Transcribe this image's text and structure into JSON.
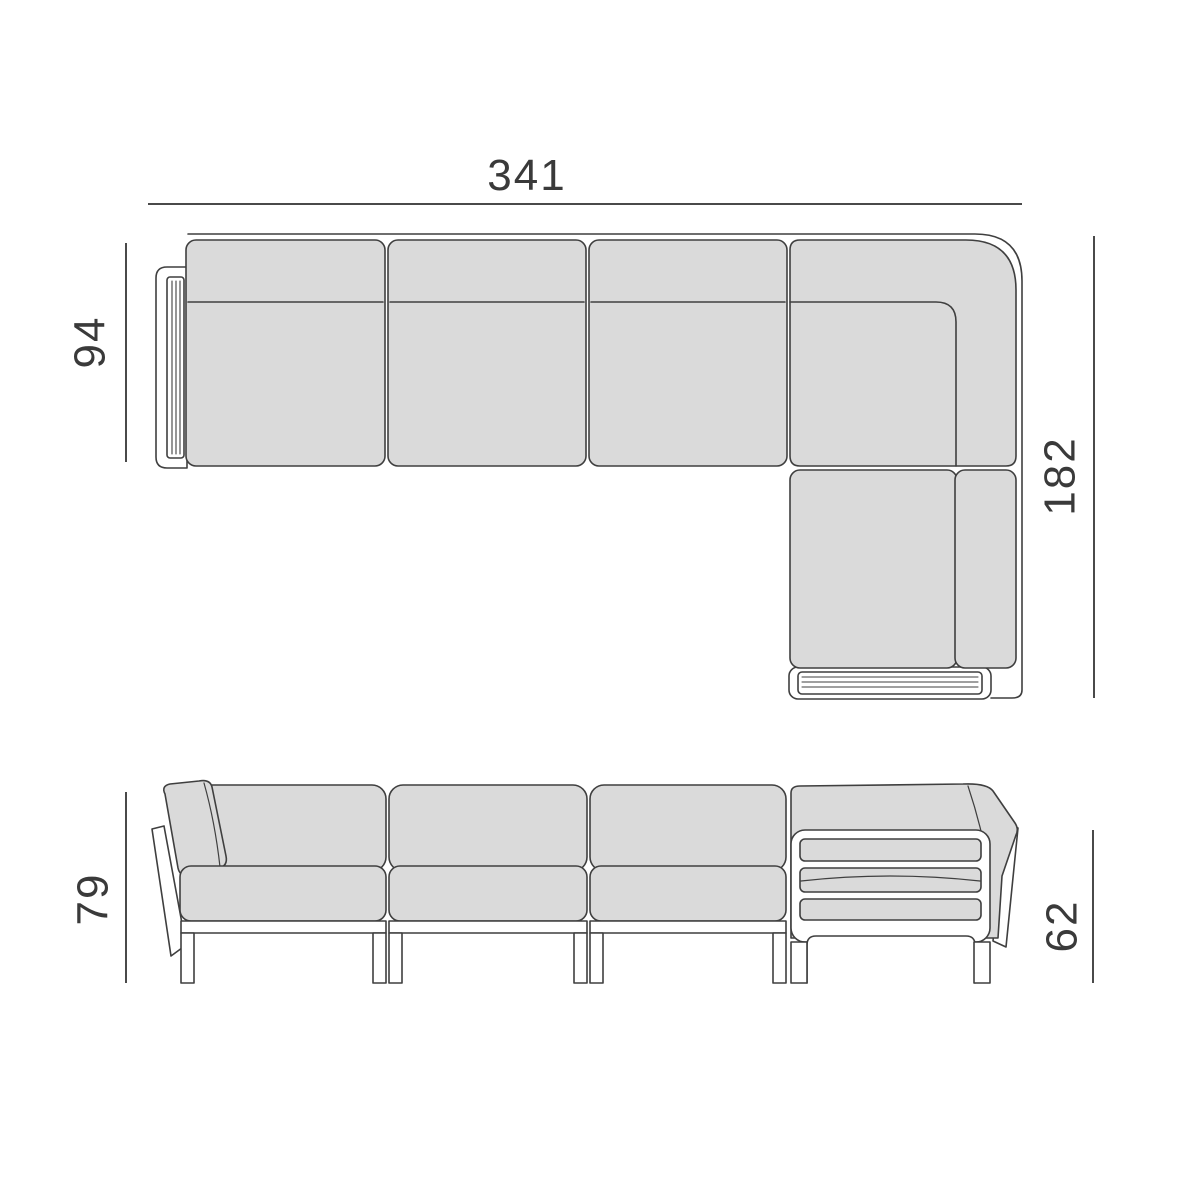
{
  "diagram": {
    "type": "furniture-technical-drawing",
    "views": [
      "top-plan-view",
      "front-elevation-view"
    ],
    "dims": {
      "overall_width": "341",
      "seat_depth": "94",
      "chaise_depth": "182",
      "overall_height": "79",
      "side_frame_height": "62"
    },
    "colors": {
      "background": "#ffffff",
      "cushion_fill": "#dadada",
      "outline": "#3f3f3f",
      "dimension_line": "#4a4a4a",
      "text": "#3a3a3a"
    }
  }
}
